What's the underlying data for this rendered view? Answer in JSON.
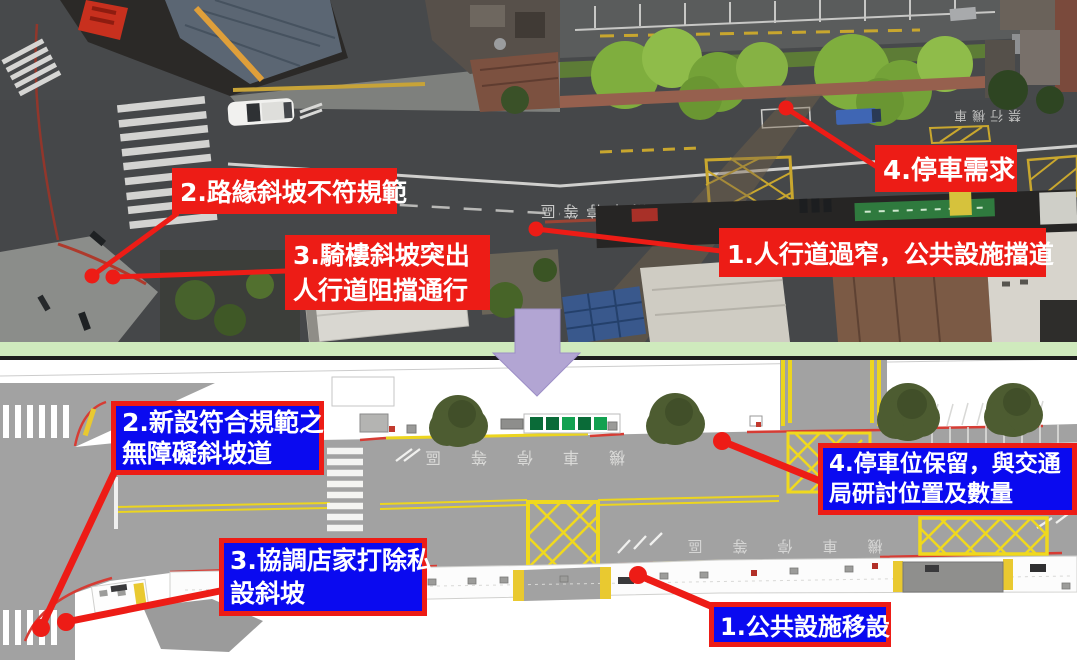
{
  "photo_annotations": {
    "item1": {
      "line1": "1.人行道過窄，公共設施擋道"
    },
    "item2": {
      "line1": "2.路緣斜坡不符規範"
    },
    "item3": {
      "line1": "3.騎樓斜坡突出",
      "line2": "人行道阻擋通行"
    },
    "item4": {
      "line1": "4.停車需求"
    }
  },
  "plan_annotations": {
    "item1": {
      "line1": "1.公共設施移設"
    },
    "item2": {
      "line1": "2.新設符合規範之",
      "line2": "無障礙斜坡道"
    },
    "item3": {
      "line1": "3.協調店家打除私",
      "line2": "設斜坡"
    },
    "item4": {
      "line1": "4.停車位保留，與交通",
      "line2": "局研討位置及數量"
    }
  },
  "road_markings": {
    "photo_center_lane": "機車停等區",
    "photo_right_lane": "禁行機車",
    "plan_upper_lane": "機車停等區",
    "plan_lower_lane": "機車停等區"
  },
  "colors": {
    "annotation-red": "#ed1c16",
    "annotation-blue": "#0a0af0",
    "leader-red": "#ed1c16",
    "green-strip": "#cfeabd",
    "divider-black": "#1d1d1d",
    "arrow-purple": "#b2a5d3",
    "plan-road-gray": "#a2a2a2",
    "hatch-yellow": "#f0d91e",
    "curb-red": "#d63c34",
    "tree-dark-green": "#4d5c31"
  }
}
